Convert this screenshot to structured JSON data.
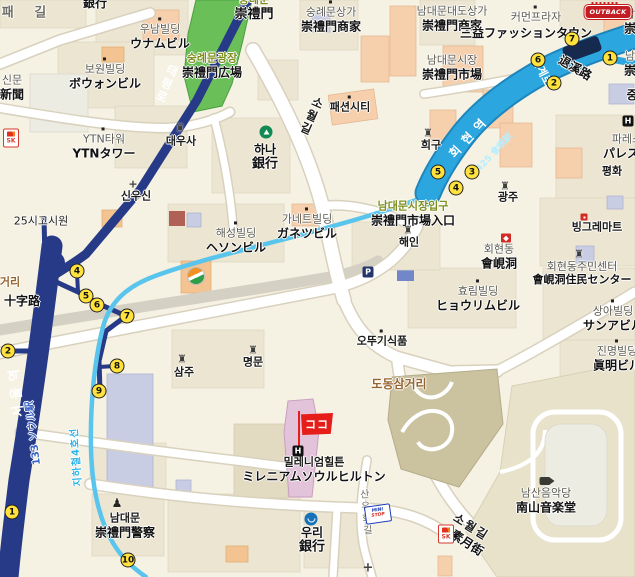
{
  "map": {
    "colors": {
      "bg": "#f5f1e3",
      "navy": "#273a87",
      "band": "#2ca6de",
      "band-edge": "#1e86bc",
      "cyan": "#5ac5ec",
      "park": "#6abf58",
      "khaki": "#cbc2a0",
      "road": "#ffffff",
      "badge": "#ffe23e",
      "red": "#e61e19"
    },
    "labels": [
      {
        "n": "chilpae-gil-road",
        "x": 28,
        "y": 13,
        "ko": "패 길",
        "kc": "g2 b",
        "ks": 13,
        "ls": 8
      },
      {
        "n": "bank-partial-top",
        "x": 95,
        "y": 3,
        "ko": "銀行",
        "kc": "bk bb",
        "ks": 12
      },
      {
        "n": "unam-building",
        "x": 160,
        "y": 37,
        "ko": "우남빌딩",
        "ja": "ウナムビル",
        "dot": 1
      },
      {
        "n": "bowon-building",
        "x": 105,
        "y": 77,
        "ko": "보원빌딩",
        "ja": "ボウォンビル",
        "dot": 1
      },
      {
        "n": "shinmun",
        "x": 12,
        "y": 88,
        "ko": "신문",
        "ja": "新聞"
      },
      {
        "n": "ytn-tower",
        "x": 104,
        "y": 147,
        "ko": "YTN타워",
        "ja": "YTNタワー",
        "dot": 1
      },
      {
        "n": "daewoosa",
        "x": 181,
        "y": 142,
        "ko": "대우사",
        "kc": "bk b"
      },
      {
        "n": "taepyeongno-road",
        "x": 166,
        "y": 84,
        "ko": "태평로",
        "kc": "wt b",
        "ks": 12,
        "vert": 1,
        "rot": 22
      },
      {
        "n": "sungnyemun",
        "x": 254,
        "y": 8,
        "ko": "숭례문",
        "ja": "崇禮門",
        "kc": "ol",
        "js": 13
      },
      {
        "n": "sungnyemun-plaza",
        "x": 212,
        "y": 66,
        "ko": "숭례문광장",
        "ja": "崇禮門広場",
        "kc": "ol"
      },
      {
        "n": "sungnyemun-shops",
        "x": 331,
        "y": 20,
        "ko": "숭례문상가",
        "ja": "崇禮門商家",
        "dot": 1
      },
      {
        "n": "namdaemun-daedo-shops",
        "x": 452,
        "y": 19,
        "ko": "남대문대도상가",
        "ja": "崇禮門商家"
      },
      {
        "n": "common-plaza",
        "x": 536,
        "y": 18,
        "ko": "커먼프라자",
        "dot": 1
      },
      {
        "n": "samik-fashion-town",
        "x": 526,
        "y": 33,
        "ko": "三益ファッションタウン",
        "kc": "bk bb",
        "ks": 12
      },
      {
        "n": "namdaemun-market",
        "x": 452,
        "y": 68,
        "ko": "남대문시장",
        "ja": "崇禮門市場"
      },
      {
        "n": "fashion-city",
        "x": 350,
        "y": 108,
        "ko": "패션시티",
        "kc": "bk b",
        "dot": 1
      },
      {
        "n": "hana-bank",
        "x": 265,
        "y": 157,
        "ko": "하나",
        "ja": "銀行",
        "kc": "bk bb",
        "ks": 12,
        "js": 13
      },
      {
        "n": "huigu",
        "x": 431,
        "y": 146,
        "ko": "희구",
        "kc": "bk b"
      },
      {
        "n": "gwangju",
        "x": 508,
        "y": 198,
        "ko": "광주",
        "kc": "bk b"
      },
      {
        "n": "edge-label-top",
        "x": 630,
        "y": 22,
        "ko": "남",
        "ja": "崇"
      },
      {
        "n": "edge-label-mid",
        "x": 630,
        "y": 64,
        "ko": "남",
        "ja": "崇"
      },
      {
        "n": "jung-partial",
        "x": 632,
        "y": 95,
        "ko": "중",
        "kc": "bk bb",
        "ks": 12
      },
      {
        "n": "palace-hotel",
        "x": 627,
        "y": 147,
        "ko": "파레스",
        "ja": "パレスホ"
      },
      {
        "n": "pyeonghwa",
        "x": 612,
        "y": 172,
        "ko": "평화",
        "kc": "bk b"
      },
      {
        "n": "toegyero-ko",
        "x": 541,
        "y": 72,
        "ko": "퇴계로",
        "kc": "wt b",
        "rot": 64,
        "ks": 11
      },
      {
        "n": "toegyero-ja",
        "x": 575,
        "y": 68,
        "ko": "退溪路",
        "kc": "bk bb",
        "rot": 30,
        "ks": 12
      },
      {
        "n": "hoehyeon-station",
        "x": 470,
        "y": 136,
        "ko": "회현역",
        "kc": "wt b",
        "rot": -47,
        "ks": 12,
        "ls": 7
      },
      {
        "n": "hoehyeon-station-number",
        "x": 495,
        "y": 153,
        "ko": "425 會峴駅",
        "kc": "cy b",
        "rot": -47,
        "ks": 9
      },
      {
        "n": "sowolgil-road-top",
        "x": 311,
        "y": 116,
        "ko": "소월길",
        "kc": "bk b",
        "vert": 1,
        "rot": 24,
        "ks": 12
      },
      {
        "n": "gosiwon-25si",
        "x": 41,
        "y": 222,
        "ko": "25시고시원",
        "kc": "bk"
      },
      {
        "n": "geori-partial",
        "x": 10,
        "y": 283,
        "ko": "거리",
        "kc": "br b"
      },
      {
        "n": "sipjaro",
        "x": 22,
        "y": 301,
        "ko": "十字路",
        "kc": "bk bb",
        "ks": 12
      },
      {
        "n": "sinusin",
        "x": 136,
        "y": 197,
        "ko": "신우신",
        "kc": "bk b"
      },
      {
        "n": "haeseong-building",
        "x": 236,
        "y": 241,
        "ko": "해성빌딩",
        "ja": "ヘソンビル",
        "dot": 1
      },
      {
        "n": "garnet-building",
        "x": 307,
        "y": 227,
        "ko": "가네트빌딩",
        "ja": "ガネツビル",
        "dot": 1
      },
      {
        "n": "namdaemun-market-entrance",
        "x": 413,
        "y": 214,
        "ko": "남대문시장입구",
        "ja": "崇禮門市場入口",
        "kc": "ol"
      },
      {
        "n": "haein",
        "x": 409,
        "y": 243,
        "ko": "해인",
        "kc": "bk b"
      },
      {
        "n": "hoehyeon-dong",
        "x": 499,
        "y": 257,
        "ko": "회현동",
        "ja": "會峴洞"
      },
      {
        "n": "hyorim-building",
        "x": 478,
        "y": 299,
        "ko": "효림빌딩",
        "ja": "ヒョウリムビル",
        "dot": 1
      },
      {
        "n": "binggrae-mart",
        "x": 597,
        "y": 228,
        "ko": "빙그레마트",
        "kc": "bk b"
      },
      {
        "n": "community-center",
        "x": 582,
        "y": 274,
        "ko": "회현동주민센터",
        "ja": "會峴洞住民センター",
        "js": 11
      },
      {
        "n": "sanga-building",
        "x": 613,
        "y": 319,
        "ko": "상아빌딩",
        "ja": "サンアビル",
        "dot": 1
      },
      {
        "n": "jinmyeong-building",
        "x": 617,
        "y": 359,
        "ko": "진명빌딩",
        "ja": "眞明ビル",
        "dot": 1
      },
      {
        "n": "ottogi-foods",
        "x": 382,
        "y": 342,
        "ko": "오뚜기식품",
        "kc": "bk b",
        "dot": 1
      },
      {
        "n": "dodong-samgeori",
        "x": 399,
        "y": 384,
        "ko": "도동삼거리",
        "kc": "br bb",
        "ks": 12
      },
      {
        "n": "myeongmun",
        "x": 253,
        "y": 363,
        "ko": "명문",
        "kc": "bk b"
      },
      {
        "n": "samju",
        "x": 184,
        "y": 373,
        "ko": "삼주",
        "kc": "bk b"
      },
      {
        "n": "millennium-hilton",
        "x": 314,
        "y": 470,
        "ko": "밀레니엄힐튼",
        "ja": "ミレニアムソウルヒルトン",
        "kc": "bk b"
      },
      {
        "n": "seoul-station",
        "x": 17,
        "y": 390,
        "ko": "서울역",
        "kc": "wt b",
        "rot": -96,
        "ks": 13,
        "ls": 6
      },
      {
        "n": "seoul-station-number",
        "x": 34,
        "y": 433,
        "ko": "133 ソウル駅",
        "kc": "bl b",
        "rot": -97,
        "ks": 10
      },
      {
        "n": "subway-line-4",
        "x": 77,
        "y": 457,
        "ko": "지하철4호선",
        "kc": "cy2 b",
        "rot": -94,
        "ks": 10,
        "ls": 1
      },
      {
        "n": "sanyuhwa-gil-road",
        "x": 364,
        "y": 513,
        "ko": "산유화길",
        "kc": "g2",
        "vert": 1,
        "rot": -5,
        "ks": 10
      },
      {
        "n": "namdaemun-police",
        "x": 125,
        "y": 526,
        "ko": "남대문",
        "ja": "崇禮門警察",
        "kc": "bk b"
      },
      {
        "n": "woori-bank",
        "x": 312,
        "y": 540,
        "ko": "우리",
        "ja": "銀行",
        "kc": "bk bb",
        "ks": 12,
        "js": 13
      },
      {
        "n": "namsan-music-hall",
        "x": 546,
        "y": 501,
        "ko": "남산음악당",
        "ja": "南山音楽堂"
      },
      {
        "n": "sowolgil-road-bottom-ko",
        "x": 471,
        "y": 527,
        "ko": "소월길",
        "kc": "bk b",
        "rot": 32,
        "ks": 12,
        "ls": 2
      },
      {
        "n": "sowolgil-road-bottom-ja",
        "x": 467,
        "y": 543,
        "ko": "素月街",
        "kc": "bk bb",
        "rot": 33,
        "ks": 12
      }
    ],
    "icons": [
      {
        "t": "sk",
        "x": 11,
        "y": 138,
        "txt": "SK"
      },
      {
        "t": "sk",
        "x": 446,
        "y": 534,
        "txt": "SK"
      },
      {
        "t": "outback",
        "x": 608,
        "y": 12,
        "txt": "OUTBACK"
      },
      {
        "t": "gs",
        "x": 196,
        "y": 276
      },
      {
        "t": "bank-hana",
        "x": 266,
        "y": 132
      },
      {
        "t": "bank-woori",
        "x": 311,
        "y": 519
      },
      {
        "t": "hotel",
        "x": 298,
        "y": 451,
        "txt": "H"
      },
      {
        "t": "hotel",
        "x": 628,
        "y": 121,
        "txt": "H"
      },
      {
        "t": "parking",
        "x": 368,
        "y": 272,
        "txt": "P"
      },
      {
        "t": "temple",
        "x": 180,
        "y": 128,
        "txt": "♜"
      },
      {
        "t": "temple",
        "x": 428,
        "y": 133,
        "txt": "♜"
      },
      {
        "t": "temple",
        "x": 505,
        "y": 186,
        "txt": "♜"
      },
      {
        "t": "temple",
        "x": 408,
        "y": 230,
        "txt": "♜"
      },
      {
        "t": "temple",
        "x": 253,
        "y": 350,
        "txt": "♜"
      },
      {
        "t": "temple",
        "x": 182,
        "y": 359,
        "txt": "♜"
      },
      {
        "t": "temple",
        "x": 579,
        "y": 254,
        "txt": "♜"
      },
      {
        "t": "cross",
        "x": 133,
        "y": 184,
        "txt": "+"
      },
      {
        "t": "church",
        "x": 368,
        "y": 568,
        "txt": "+"
      },
      {
        "t": "shrine",
        "x": 506,
        "y": 238
      },
      {
        "t": "mart",
        "x": 584,
        "y": 217
      },
      {
        "t": "camera",
        "x": 545,
        "y": 481
      },
      {
        "t": "police",
        "x": 117,
        "y": 503,
        "txt": "♟"
      },
      {
        "t": "ministop",
        "x": 378,
        "y": 514,
        "txt": "MINI",
        "txt2": "STOP"
      },
      {
        "t": "flag",
        "x": 317,
        "y": 424,
        "txt": "ココ"
      }
    ],
    "exit_numbers": [
      {
        "n": "1",
        "x": 610,
        "y": 58
      },
      {
        "n": "2",
        "x": 554,
        "y": 83
      },
      {
        "n": "3",
        "x": 472,
        "y": 172
      },
      {
        "n": "4",
        "x": 456,
        "y": 188
      },
      {
        "n": "5",
        "x": 438,
        "y": 172
      },
      {
        "n": "6",
        "x": 538,
        "y": 60
      },
      {
        "n": "7",
        "x": 572,
        "y": 39
      },
      {
        "n": "1",
        "x": 12,
        "y": 512
      },
      {
        "n": "2",
        "x": 8,
        "y": 351
      },
      {
        "n": "4",
        "x": 77,
        "y": 271
      },
      {
        "n": "5",
        "x": 86,
        "y": 296
      },
      {
        "n": "6",
        "x": 97,
        "y": 305
      },
      {
        "n": "7",
        "x": 127,
        "y": 316
      },
      {
        "n": "8",
        "x": 117,
        "y": 366
      },
      {
        "n": "9",
        "x": 99,
        "y": 391
      },
      {
        "n": "10",
        "x": 128,
        "y": 560
      }
    ]
  }
}
